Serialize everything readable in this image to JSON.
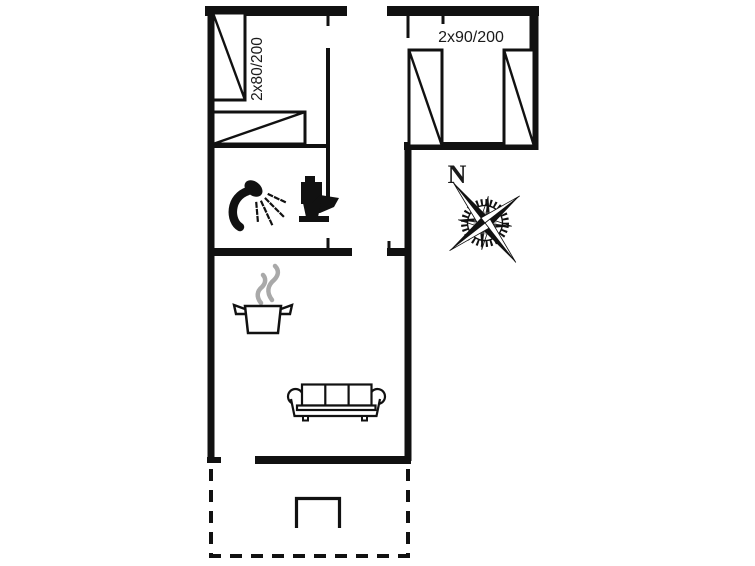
{
  "labels": {
    "bed_size_left": "2x80/200",
    "bed_size_right": "2x90/200",
    "compass_north": "N"
  },
  "colors": {
    "line": "#111111",
    "steam": "#a9a9a9",
    "background": "#ffffff"
  },
  "icons": {
    "shower": "shower-icon",
    "toilet": "toilet-icon",
    "stove": "cooking-pot-icon",
    "steam": "steam-icon",
    "sofa": "sofa-icon",
    "terrace_table": "table-icon",
    "compass": "compass-rose-icon",
    "beds": "bed-symbol"
  }
}
